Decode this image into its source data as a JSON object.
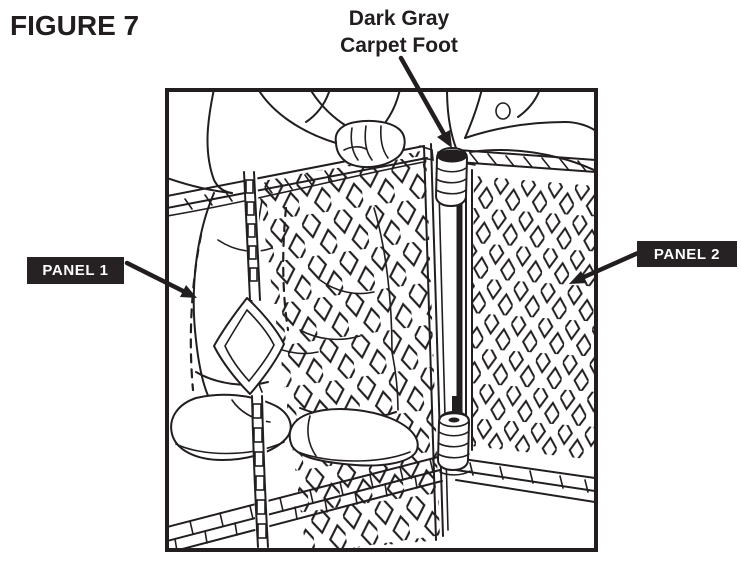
{
  "page": {
    "title": "FIGURE 7",
    "background": "#ffffff"
  },
  "callouts": {
    "carpet_foot": {
      "line1": "Dark Gray",
      "line2": "Carpet Foot"
    },
    "panel_1": {
      "label": "PANEL 1"
    },
    "panel_2": {
      "label": "PANEL 2"
    }
  },
  "colors": {
    "ink": "#221e20",
    "label_background": "#262123",
    "label_text": "#ffffff",
    "page_background": "#ffffff"
  },
  "drawing_elements": [
    "person-behind-panels",
    "panel-1-mesh",
    "panel-2-mesh",
    "hinge-pole",
    "carpet-foot-top",
    "carpet-foot-bottom",
    "hand-gripping-rail",
    "strap-with-buckle"
  ]
}
